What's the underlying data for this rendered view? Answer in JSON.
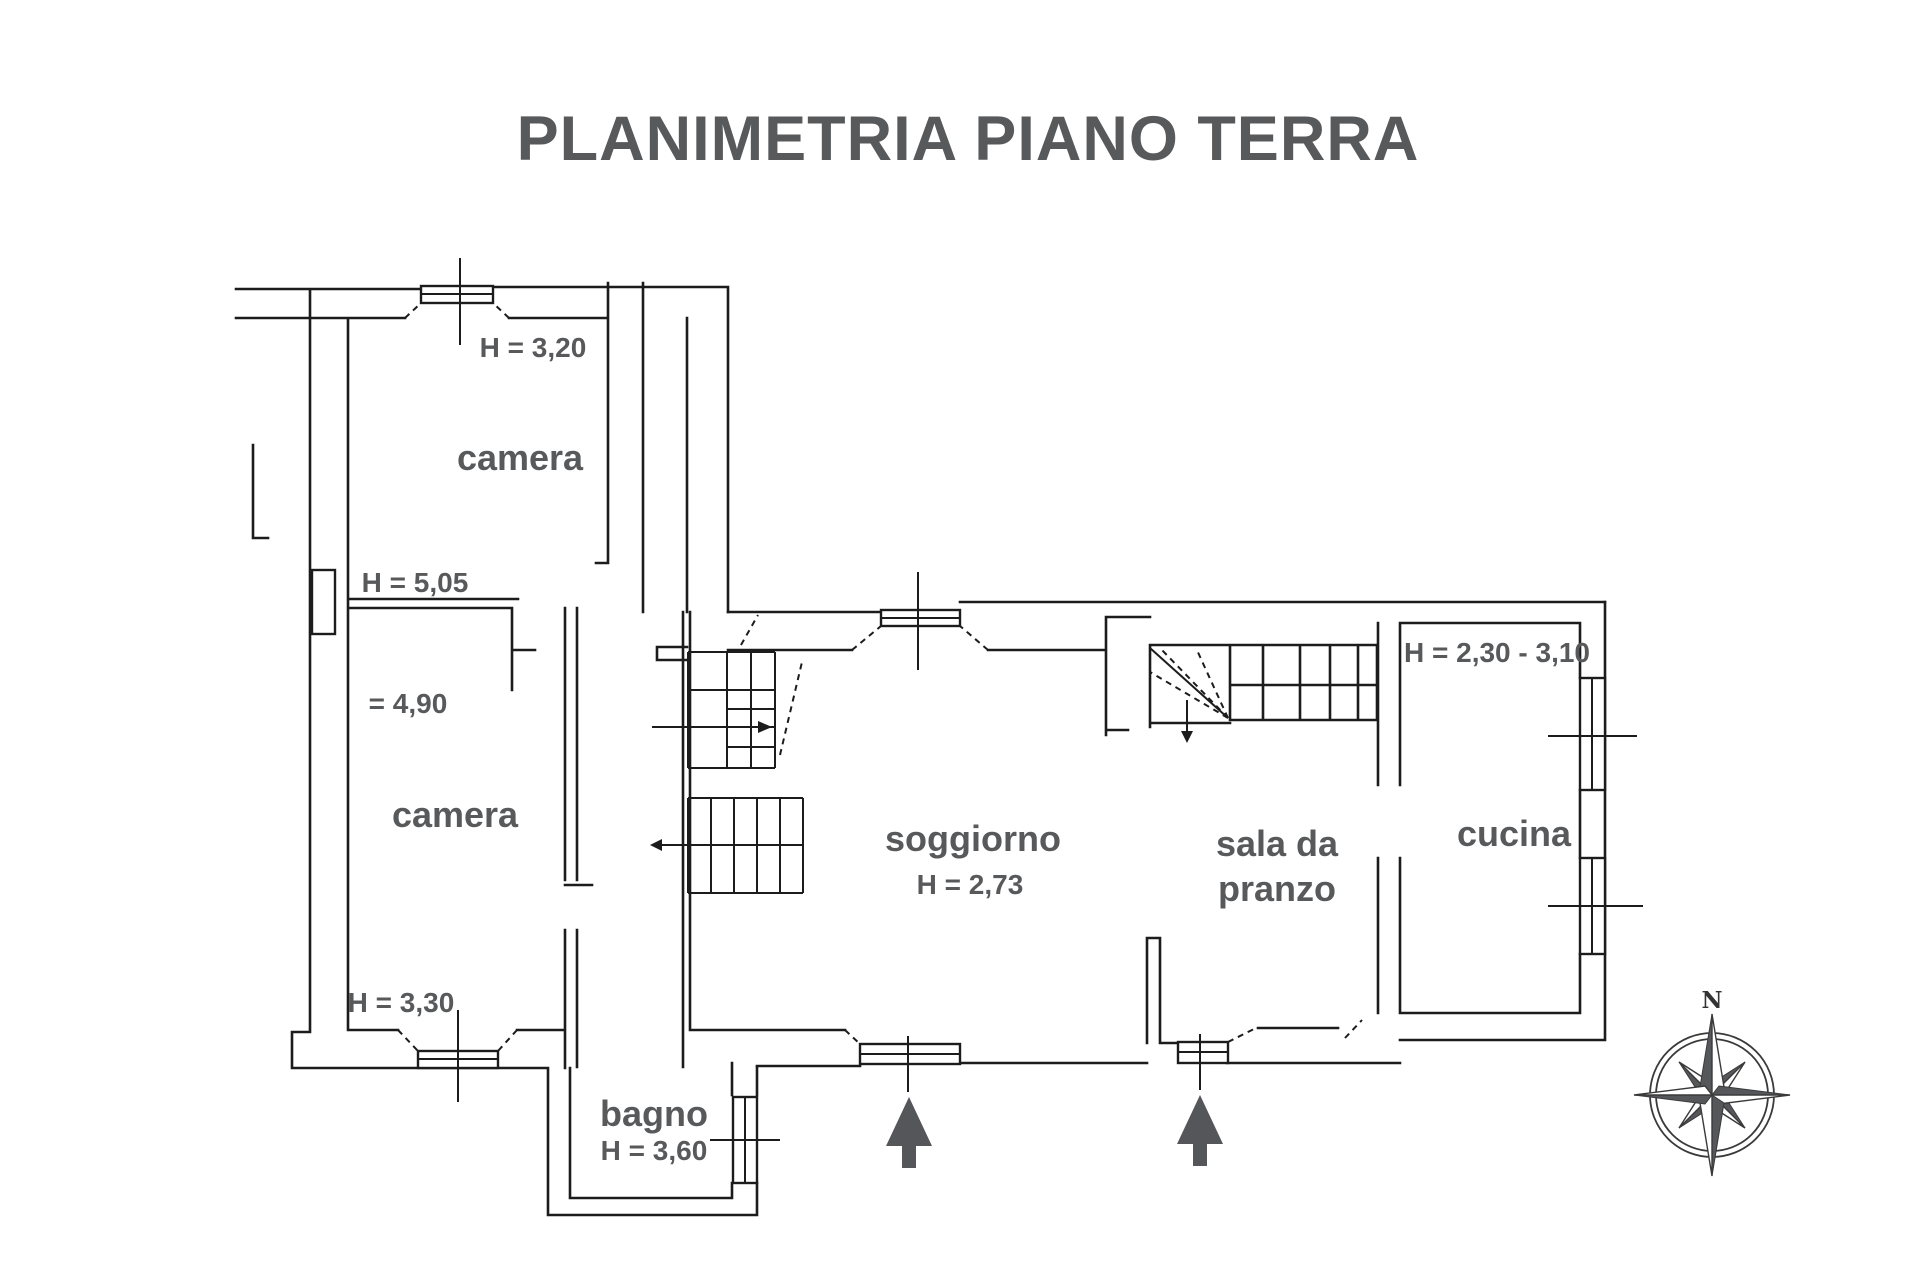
{
  "title": "PLANIMETRIA PIANO TERRA",
  "rooms": {
    "camera1": {
      "name": "camera",
      "height": "H = 3,20",
      "height_lower": "H = 5,05"
    },
    "camera2": {
      "name": "camera",
      "height_note": "= 4,90",
      "height": "H = 3,30"
    },
    "bagno": {
      "name": "bagno",
      "height": "H = 3,60"
    },
    "soggiorno": {
      "name": "soggiorno",
      "height": "H = 2,73"
    },
    "sala_da_pranzo": {
      "name_line1": "sala da",
      "name_line2": "pranzo"
    },
    "cucina": {
      "name": "cucina",
      "height": "H = 2,30 - 3,10"
    }
  },
  "compass": {
    "north_label": "N"
  },
  "colors": {
    "text": "#58595b",
    "line": "#1c1c1c",
    "entry_arrow": "#54565a"
  }
}
